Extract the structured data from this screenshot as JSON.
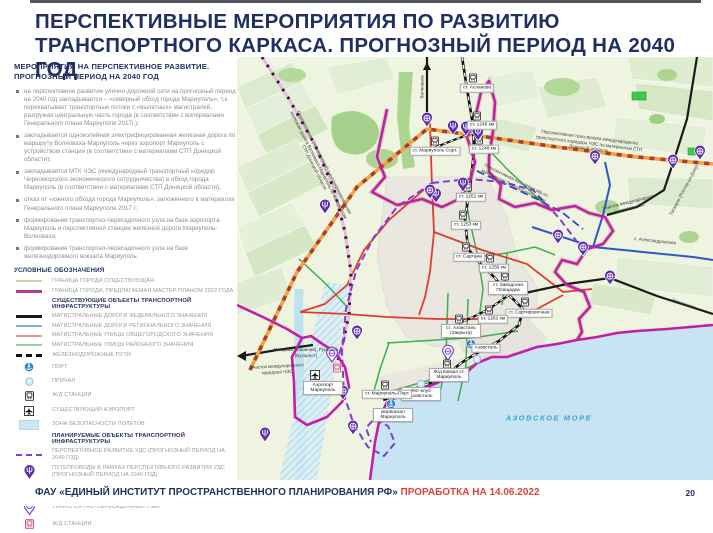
{
  "page": {
    "title": "ПЕРСПЕКТИВНЫЕ МЕРОПРИЯТИЯ ПО РАЗВИТИЮ ТРАНСПОРТНОГО КАРКАСА. ПРОГНОЗНЫЙ ПЕРИОД НА 2040 ГОД",
    "footer_org": "ФАУ «ЕДИНЫЙ ИНСТИТУТ ПРОСТРАНСТВЕННОГО ПЛАНИРОВАНИЯ РФ»",
    "footer_note": "ПРОРАБОТКА НА 14.06.2022",
    "page_number": "20"
  },
  "panel": {
    "subtitle": "МЕРОПРИЯТИЯ НА ПЕРСПЕКТИВНОЕ РАЗВИТИЕ. ПРОГНОЗНЫЙ ПЕРИОД НА 2040 ГОД",
    "bullets": [
      "на перспективное развитие улично-дорожной сети на прогнозный период на 2040 год закладывается – «северный обход города Мариуполь», т.к. перехватывает транспортные потоки с «вылетных» магистралей, разгружая центральную часть города (в соответствии с материалами Генерального плана Мариуполя 2017г.);",
      "закладывается одноколейная электрифицированная железная дорога по маршруту Волноваха-Мариуполь через аэропорт Мариуполь с устройством станции (в соответствии с материалами СТП Донецкой области);",
      "закладывается МТК ЧЭС (международный транспортный коридор Черноморского экономического сотрудничества) в обход города Мариуполь (в соответствии с материалами СТП Донецкой области);",
      "отказ от «южного обхода города Мариуполь», заложенного в материалах Генерального плана Мариуполя 2017 г.;",
      "формирование транспортно-пересадочного узла на базе аэропорта Мариуполь и перспективной станции железной дороги Мариуполь-Волноваха;",
      "формирование транспортно-пересадочного узла на базе железнодорожного вокзала Мариуполь."
    ]
  },
  "legend": {
    "title": "УСЛОВНЫЕ ОБОЗНАЧЕНИЯ",
    "items": [
      "ГРАНИЦА ГОРОДА СУЩЕСТВУЮЩАЯ",
      "ГРАНИЦА ГОРОДА, ПРЕДЛАГАЕМАЯ МАСТЕР-ПЛАНОМ 2022 ГОДА",
      "СУЩЕСТВУЮЩИЕ ОБЪЕКТЫ ТРАНСПОРТНОЙ ИНФРАСТРУКТУРЫ",
      "МАГИСТРАЛЬНЫЕ ДОРОГИ ФЕДЕРАЛЬНОГО ЗНАЧЕНИЯ",
      "МАГИСТРАЛЬНЫЕ ДОРОГИ РЕГИОНАЛЬНОГО ЗНАЧЕНИЯ",
      "МАГИСТРАЛЬНЫЕ УЛИЦЫ ОБЩЕГОРОДСКОГО ЗНАЧЕНИЯ",
      "МАГИСТРАЛЬНЫЕ УЛИЦЫ РАЙОННОГО ЗНАЧЕНИЯ",
      "ЖЕЛЕЗНОДОРОЖНЫЕ ПУТИ",
      "ПОРТ",
      "ПРИЧАЛ",
      "Ж/Д СТАНЦИИ",
      "СУЩЕСТВУЮЩИЙ АЭРОПОРТ",
      "ЗОНА БЕЗОПАСНОСТИ ПОЛЕТОВ",
      "ПЛАНИРУЕМЫЕ ОБЪЕКТЫ ТРАНСПОРТНОЙ ИНФРАСТРУКТУРЫ",
      "ПЕРСПЕКТИВНОЕ РАЗВИТИЕ УДС (ПРОГНОЗНЫЙ ПЕРИОД НА 2040 ГОД)",
      "ПУТЕПРОВОДЫ В РАМКАХ ПЕРСПЕКТИВНОГО РАЗВИТИЯ УДС (ПРОГНОЗНЫЙ ПЕРИОД НА 2040 ГОД)",
      "МНОГОУРОВНЕВЫЕ РАЗВЯЗКИ В РАМКАХ ПЕРСПЕКТИВНОГО РАЗВИТИЯ УДС (ПРОГНОЗНЫЙ ПЕРИОД НА 2040 ГОД)",
      "ТРАНСПОРТНО-ПЕРЕСАДОЧНЫЙ УЗЕЛ",
      "Ж/Д СТАНЦИИ"
    ]
  },
  "map": {
    "sea": "АЗОВСКОЕ МОРЕ",
    "corridor_line": "Перспективная трассировка международного транспортного коридора ЧЭС по материалам СТП Донецкой области",
    "railway_line": "Перспективная (планируемая) электрифицированная железная дорога Волноваха-Мариуполь по материалам СТП Донецкой области",
    "ring_line": "Перспективная кольцевая а/д по материалам Генерального плана",
    "corridor_section_left": "Участок международного коридора ЧЭС",
    "corridor_section_right": "Участок международного коридора ЧЭС",
    "dir_volnovakha": "Волноваха",
    "dir_moldova": "Молдова (Кишинев), Румыния (Бухарест)",
    "dir_taganrog": "Таганрог (Ростов-на-Дону)",
    "dir_novoazovsk": "Новоазовск",
    "dir_alexandrovskoe": "с. Александровское",
    "st_aslanovo": "ст. Асланово",
    "st_1246": "ст. 1246 км",
    "st_1248": "ст. 1248 км",
    "st_sort": "ст. Мариуполь-Сорт.",
    "st_1251": "ст. 1251 км",
    "st_1253": "ст. 1253 км",
    "st_sartana": "ст. Сартана",
    "st_1256": "ст. 1256 км",
    "st_zavodskaya": "ст. Заводская Площадка",
    "st_sortirovochnaya": "ст. Сортировочная",
    "st_azovstal": "ст. Азовсталь (Закрыта)",
    "st_1261": "ст. 1261 км",
    "airport": "Аэропорт Мариуполь",
    "rail_terminal": "Ж/д вокзал ст. Мариуполь",
    "yacht_club": "Яхт-клуб Азовсталь",
    "sea_terminal": "морвокзал Мариуполь",
    "azovstal_port": "Азовсталь",
    "st_port": "ст. Мариуполь-Порт"
  },
  "colors": {
    "title_navy": "#1f2f5f",
    "footer_red": "#d8453c",
    "boundary_masterplan": "#b13b9e",
    "boundary_existing": "#cfd2ad",
    "planned_uds_purple": "#7b3fd4",
    "corridor_orange": "#f0a43c",
    "sea_blue": "#c6e4f3",
    "road_federal": "#1a1a1a",
    "road_regional": "#2f55c9",
    "street_city": "#e03b2f",
    "street_district": "#3fae4c"
  }
}
